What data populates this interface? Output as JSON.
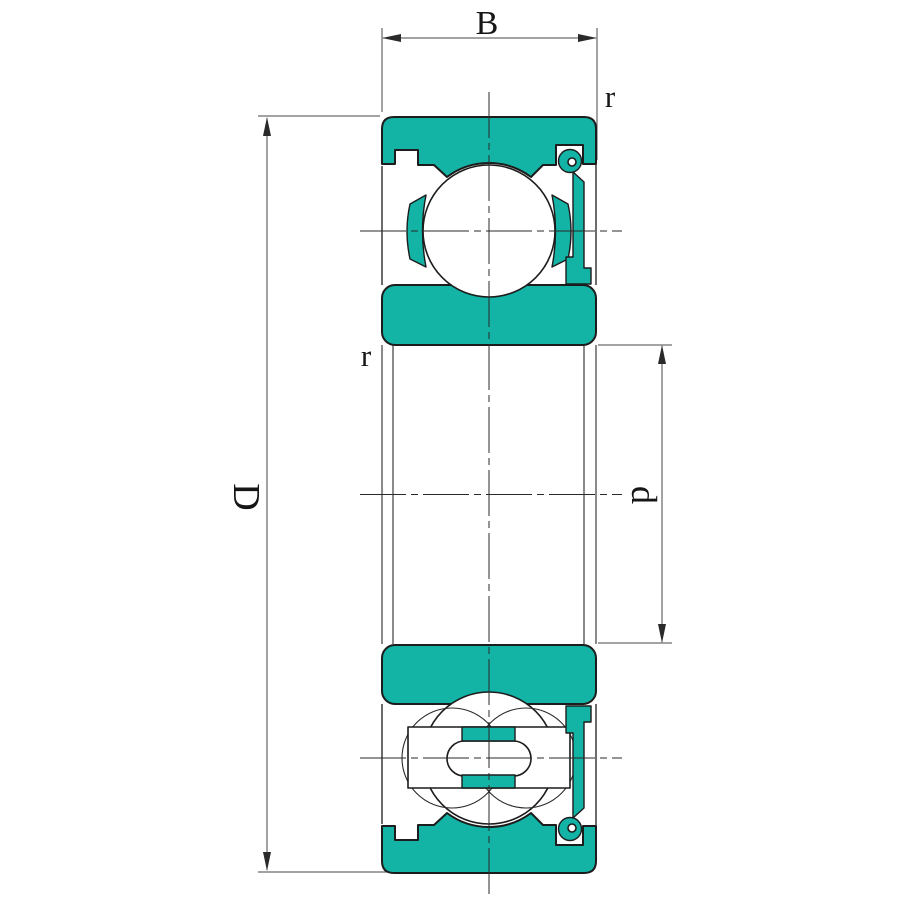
{
  "drawing": {
    "kind": "bearing-cross-section",
    "labels": {
      "width": "B",
      "outer_diameter": "D",
      "bore_diameter": "d",
      "outer_ring_chamfer": "r",
      "inner_ring_chamfer": "r"
    },
    "colors": {
      "part_fill": "#13b3a6",
      "outline": "#1c1c1c",
      "dimension_lines": "#474747",
      "background": "#ffffff"
    }
  }
}
